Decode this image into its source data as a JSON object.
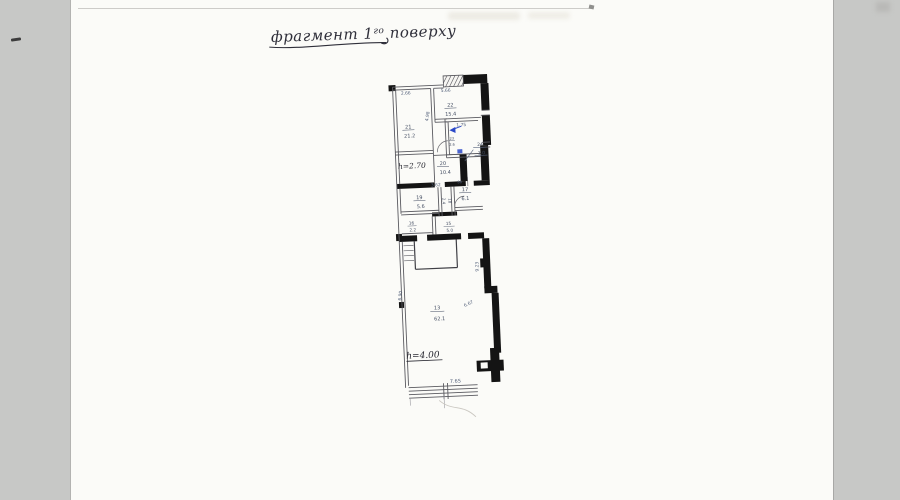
{
  "document": {
    "title": {
      "prefix": "фрагмент 1",
      "superscript": "го",
      "suffix": " поверху"
    },
    "plan": {
      "rooms": [
        {
          "number": "21",
          "area": "21.2"
        },
        {
          "number": "22",
          "area": "15.4"
        },
        {
          "number": "23",
          "area": "2.6"
        },
        {
          "number": "20",
          "area": "10.4"
        },
        {
          "number": "24",
          "area": "1.0"
        },
        {
          "number": "19",
          "area": "5.6"
        },
        {
          "number": "18",
          "area": "2.4"
        },
        {
          "number": "17",
          "area": "6.1"
        },
        {
          "number": "16",
          "area": "2.2"
        },
        {
          "number": "15",
          "area": "5.0"
        },
        {
          "number": "13",
          "area": "62.1"
        }
      ],
      "dimensions": {
        "top_left": "2.66",
        "top_right": "5.66",
        "left_vertical": "4.98",
        "stair_opening": "1.75",
        "room19_width": "3.62",
        "room17_small": "88",
        "hall_right_vertical": "9.23",
        "hall_left_vertical": "6.90",
        "hall_right_lower": "6.67",
        "bottom_width": "7.65"
      },
      "annotations": {
        "ceiling_height_upper": "h=2.70",
        "ceiling_height_hall": "h=4.00"
      },
      "colors": {
        "ink_blue": "#2b49c8",
        "pencil_ink": "#53607a",
        "wall_black": "#141414"
      }
    }
  }
}
